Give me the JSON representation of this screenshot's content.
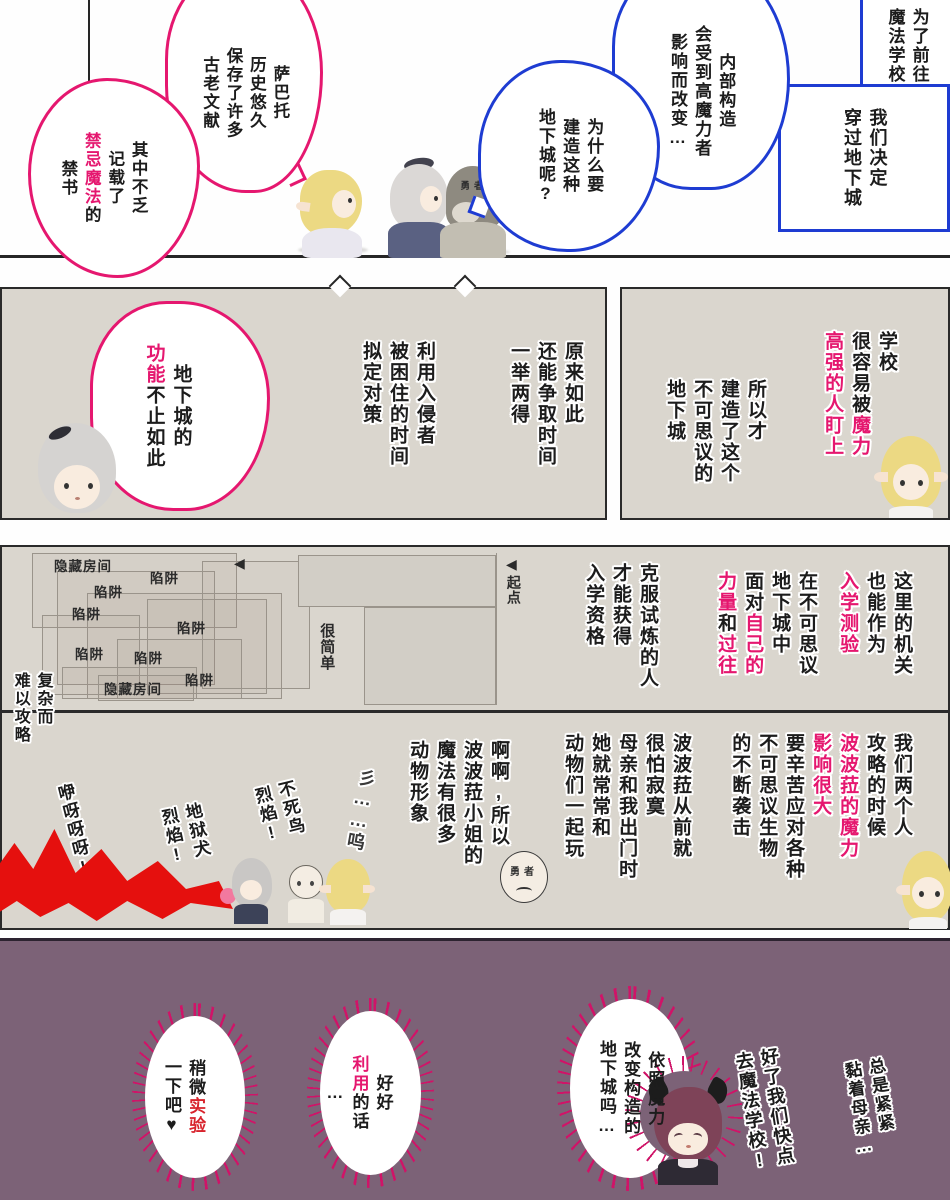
{
  "colors": {
    "pink": "#e5176f",
    "blue": "#1e3cd2",
    "red_text": "#d8232c",
    "beige_panel": "#dad6ce",
    "purple_panel": "#7c6277",
    "red_splash": "#e5100e"
  },
  "panel_top": {
    "narration_corner": "为了前往\n魔法学校",
    "narration_box": "我们决定\n穿过地下城",
    "bubble_structure": "内部构造\n会受到高魔力者\n影响而改变…",
    "bubble_why": "为什么要\n建造这种\n地下城呢?",
    "bubble_sabbato": "萨巴托\n历史悠久\n保存了许多\n古老文献",
    "bubble_forbidden": {
      "pre": "其中不乏\n记载了\n",
      "em": "禁忌魔法",
      "post": "的\n禁书"
    },
    "hood_label": "勇者"
  },
  "panel_school": {
    "line_target": {
      "pre": "学校\n很容易被",
      "em": "魔力\n高强的人盯上"
    },
    "line_built": "所以才\n建造了这个\n不可思议的\n地下城"
  },
  "panel_isee": {
    "line_isee": "原来如此\n还能争取时间\n一举两得",
    "line_plan": "利用入侵者\n被困住的时间\n拟定对策",
    "bubble_function": {
      "pre": "地下城的\n",
      "em": "功能",
      "post": "不止如此"
    }
  },
  "panel_map": {
    "labels": {
      "hidden_room_top": "隐藏房间",
      "hidden_room_bottom": "隐藏房间",
      "trap": "陷阱",
      "start": "起点",
      "simple": "很简单",
      "complex": "复杂而\n难以攻略",
      "arrow_left": "◀"
    },
    "line_entry_test": {
      "pre": "这里的机关\n也能作为\n",
      "em": "入学测验"
    },
    "line_face": {
      "pre": "在不可思议\n地下城中\n面对",
      "em1": "自己的",
      "br": "\n",
      "em2": "力量",
      "mid": "和",
      "em3": "过往"
    },
    "line_qualify": "克服试炼的人\n才能获得\n入学资格"
  },
  "panel_popola": {
    "line_raid": {
      "pre": "我们两个人\n攻略的时候\n",
      "em": "波波菈的魔力\n影响很大",
      "post": "\n要辛苦应对各种\n不可思议生物\n的不断袭击"
    },
    "line_lonely": "波波菈从前就\n很怕寂寞\n母亲和我出门时\n她就常常和\n动物们一起玩",
    "line_animals": "啊啊,所以\n波波菈小姐的\n魔法有很多\n动物形象",
    "sfx_tremble": "彡……呜",
    "shout_phoenix": "不死鸟\n烈焰!",
    "shout_hellhound": "地狱犬\n烈焰!",
    "scream": "咿呀呀呀!",
    "hero_label": "勇者"
  },
  "panel_purple": {
    "bubble_dungeon": "依照魔力\n改变构造的\n地下城吗…",
    "bubble_use": {
      "pre": "好好\n",
      "em": "利用",
      "post": "的话\n…"
    },
    "bubble_experiment": {
      "pre": "稍微",
      "em": "实验",
      "post": "\n一下吧♥"
    },
    "mutter_clingy": "总是紧紧\n黏着母亲…",
    "shout_school": "好了我们快点\n去魔法学校!"
  }
}
